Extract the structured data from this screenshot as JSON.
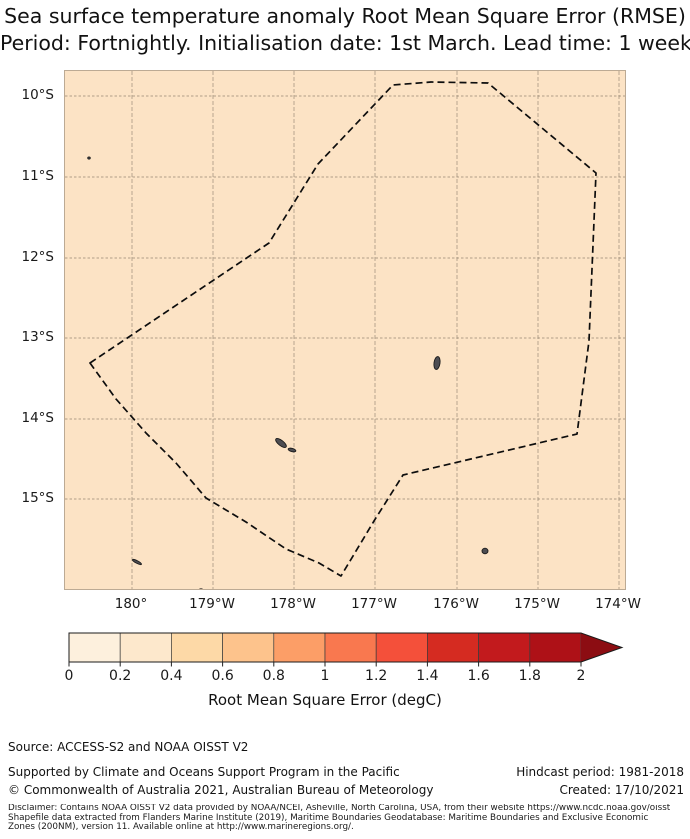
{
  "title": {
    "line1": "Sea surface temperature anomaly Root Mean Square Error (RMSE)",
    "line2": "Period: Fortnightly. Initialisation date: 1st March. Lead time: 1 week"
  },
  "map": {
    "background_color": "#fce3c5",
    "grid_color": "rgba(115,102,85,0.55)",
    "boundary_color": "#0d0d0d",
    "island_fill": "#4d4d52",
    "island_stroke": "#1c1c1c",
    "region": "Fiji Exclusive Economic Zone (dashed boundary)",
    "lat_ticks": [
      {
        "label": "10°S",
        "y": 95
      },
      {
        "label": "11°S",
        "y": 176
      },
      {
        "label": "12°S",
        "y": 257
      },
      {
        "label": "13°S",
        "y": 337
      },
      {
        "label": "14°S",
        "y": 418
      },
      {
        "label": "15°S",
        "y": 498
      }
    ],
    "lon_ticks": [
      {
        "label": "180°",
        "x": 131
      },
      {
        "label": "179°W",
        "x": 212
      },
      {
        "label": "178°W",
        "x": 293
      },
      {
        "label": "177°W",
        "x": 374
      },
      {
        "label": "176°W",
        "x": 456
      },
      {
        "label": "175°W",
        "x": 537
      },
      {
        "label": "174°W",
        "x": 618
      }
    ],
    "eez_boundary_points": [
      [
        25,
        292
      ],
      [
        204,
        172
      ],
      [
        253,
        93
      ],
      [
        328,
        14
      ],
      [
        366,
        11
      ],
      [
        423,
        12
      ],
      [
        531,
        102
      ],
      [
        524,
        270
      ],
      [
        512,
        363
      ],
      [
        338,
        404
      ],
      [
        309,
        450
      ],
      [
        276,
        505
      ],
      [
        254,
        492
      ],
      [
        221,
        478
      ],
      [
        181,
        451
      ],
      [
        141,
        427
      ],
      [
        111,
        392
      ],
      [
        81,
        362
      ],
      [
        51,
        328
      ]
    ],
    "islands": [
      {
        "cx": 24,
        "cy": 87,
        "rx": 1.3,
        "ry": 1.1,
        "rot": 0
      },
      {
        "cx": 216,
        "cy": 372,
        "rx": 6.5,
        "ry": 2.6,
        "rot": 38
      },
      {
        "cx": 227,
        "cy": 379,
        "rx": 4.0,
        "ry": 1.6,
        "rot": 15
      },
      {
        "cx": 372,
        "cy": 292,
        "rx": 3.0,
        "ry": 6.5,
        "rot": 8
      },
      {
        "cx": 420,
        "cy": 480,
        "rx": 3.0,
        "ry": 2.8,
        "rot": 0
      },
      {
        "cx": 72,
        "cy": 491,
        "rx": 5.0,
        "ry": 1.3,
        "rot": 27
      },
      {
        "cx": 136,
        "cy": 519,
        "rx": 1.8,
        "ry": 1.2,
        "rot": 0
      }
    ]
  },
  "colorbar": {
    "x_start": 69,
    "x_end": 581,
    "arrow_tip_x": 622,
    "y_top": 8,
    "height": 29,
    "tick_labels": [
      "0",
      "0.2",
      "0.4",
      "0.6",
      "0.8",
      "1",
      "1.2",
      "1.4",
      "1.6",
      "1.8",
      "2"
    ],
    "segment_colors": [
      "#fdf0dd",
      "#fde8cc",
      "#fdd9a7",
      "#fdc38c",
      "#fc9e67",
      "#f9784f",
      "#f4503a",
      "#d52b21",
      "#c21a1d",
      "#ae1117"
    ],
    "arrow_color": "#8c0d12",
    "divider_color": "#3c3c3c",
    "outline_color": "#1b1b1b",
    "label": "Root Mean Square Error (degC)"
  },
  "footer": {
    "source": "Source: ACCESS-S2 and NOAA OISST V2",
    "supported": "Supported by Climate and Oceans Support Program in the Pacific",
    "copyright": "© Commonwealth of Australia 2021, Australian Bureau of Meteorology",
    "hindcast": "Hindcast period: 1981-2018",
    "created": "Created: 17/10/2021",
    "disclaimer_line1": "Disclaimer: Contains NOAA OISST V2 data provided by NOAA/NCEI, Asheville, North Carolina, USA, from their website https://www.ncdc.noaa.gov/oisst",
    "disclaimer_line2": "Shapefile data extracted from Flanders Marine Institute (2019), Maritime Boundaries Geodatabase: Maritime Boundaries and Exclusive Economic",
    "disclaimer_line3": "Zones (200NM), version 11. Available online at http://www.marineregions.org/."
  },
  "chart_data": {
    "type": "map",
    "title": "Sea surface temperature anomaly Root Mean Square Error (RMSE)",
    "subtitle": "Period: Fortnightly. Initialisation date: 1st March. Lead time: 1 week",
    "region": "Fiji EEZ, approx 179°E to 174°W, 9.7°S to 16.1°S",
    "lon_tick_labels": [
      "180°",
      "179°W",
      "178°W",
      "177°W",
      "176°W",
      "175°W",
      "174°W"
    ],
    "lat_tick_labels": [
      "10°S",
      "11°S",
      "12°S",
      "13°S",
      "14°S",
      "15°S"
    ],
    "colorbar": {
      "label": "Root Mean Square Error (degC)",
      "range": [
        0,
        2
      ],
      "step": 0.2,
      "extend": "max",
      "n_segments": 10
    },
    "field_description": "RMSE field approximately uniform ~0.3-0.4 degC across shown domain"
  }
}
